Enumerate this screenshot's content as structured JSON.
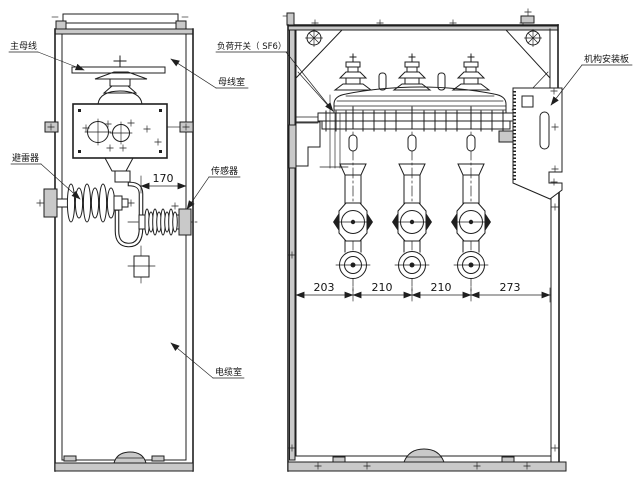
{
  "drawing": {
    "colors": {
      "paper": "#ffffff",
      "ink": "#1f1f1f"
    },
    "labels": {
      "main_bus": "主母线",
      "busbar_compartment": "母线室",
      "load_switch": "负荷开关（ SF6）",
      "arrester": "避雷器",
      "sensor": "传感器",
      "cable_compartment": "电缆室",
      "mechanism_mounting_plate": "机构安装板"
    },
    "dimensions": {
      "arrester_clearance": "170",
      "bottom": [
        "203",
        "210",
        "210",
        "273"
      ]
    }
  }
}
